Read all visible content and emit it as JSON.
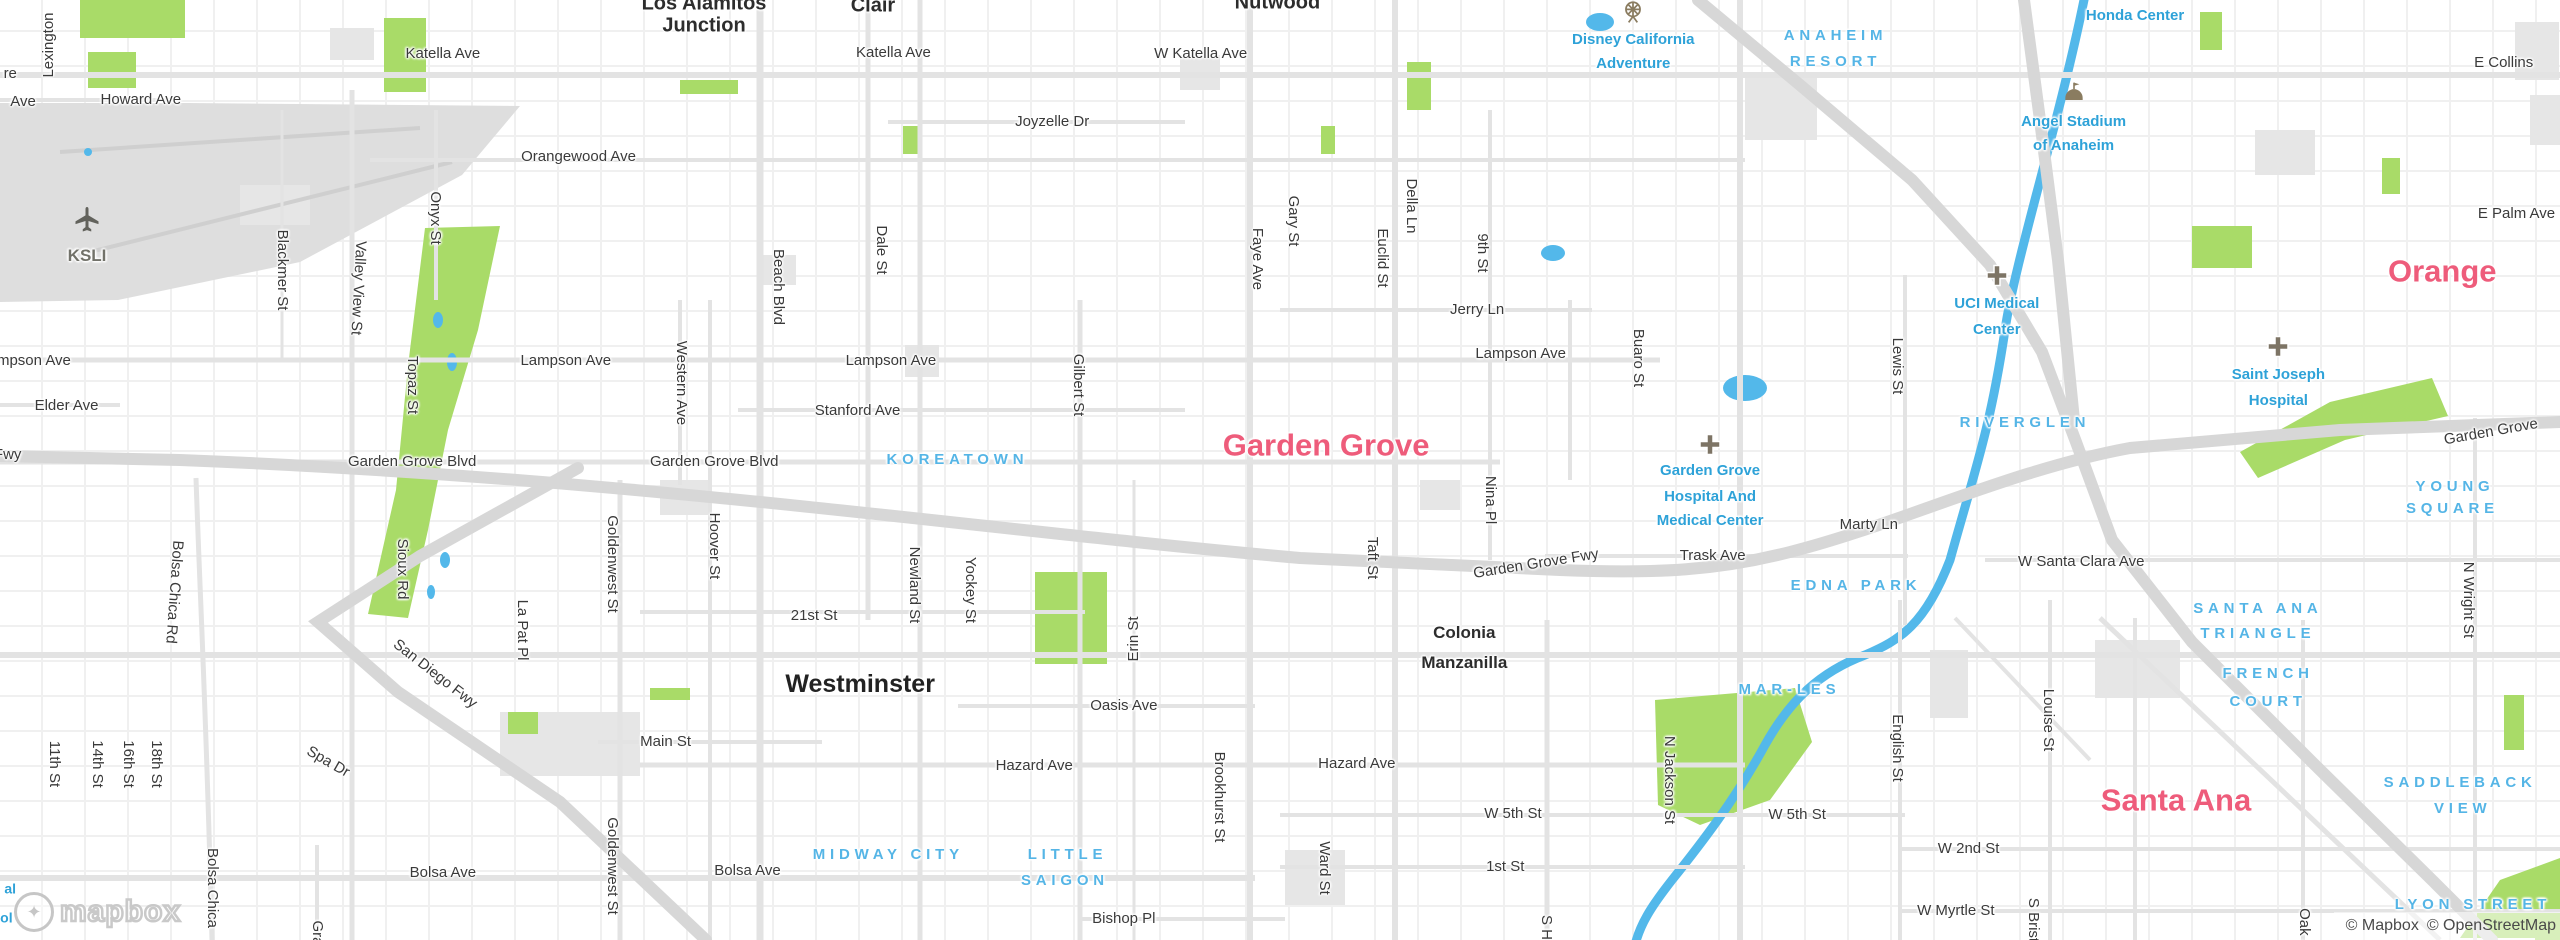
{
  "map": {
    "logo_text": "mapbox",
    "attribution": {
      "mapbox": "© Mapbox",
      "osm": "© OpenStreetMap"
    },
    "colors": {
      "city_label": "#ee5c7b",
      "poi_label": "#2ea2d8",
      "neighborhood_label": "#55b5e6",
      "street_label": "#3a3a3a",
      "park_green": "#a9db68",
      "water_blue": "#53b8ea",
      "freeway_gray": "#d7d7d7",
      "road_gray": "#e3e3e3",
      "urban_gray": "#e6e6e6"
    },
    "labels": [
      {
        "t": "re",
        "x": 0.4,
        "y": 7.9,
        "k": "st"
      },
      {
        "t": "Ave",
        "x": 0.9,
        "y": 10.9,
        "k": "st"
      },
      {
        "t": "Howard Ave",
        "x": 5.5,
        "y": 10.6,
        "k": "st"
      },
      {
        "t": "Katella Ave",
        "x": 17.3,
        "y": 5.7,
        "k": "st"
      },
      {
        "t": "Katella Ave",
        "x": 34.9,
        "y": 5.6,
        "k": "st"
      },
      {
        "t": "W Katella Ave",
        "x": 46.9,
        "y": 5.7,
        "k": "st"
      },
      {
        "t": "Joyzelle Dr",
        "x": 41.1,
        "y": 13.0,
        "k": "st"
      },
      {
        "t": "Orangewood Ave",
        "x": 22.6,
        "y": 16.7,
        "k": "st"
      },
      {
        "t": "E Collins",
        "x": 97.8,
        "y": 6.7,
        "k": "st"
      },
      {
        "t": "E Palm Ave",
        "x": 98.3,
        "y": 22.8,
        "k": "st"
      },
      {
        "t": "Jerry Ln",
        "x": 57.7,
        "y": 33.0,
        "k": "st"
      },
      {
        "t": "Lampson Ave",
        "x": 1.0,
        "y": 38.4,
        "k": "st"
      },
      {
        "t": "Elder Ave",
        "x": 2.6,
        "y": 43.2,
        "k": "st"
      },
      {
        "t": "Lampson Ave",
        "x": 22.1,
        "y": 38.4,
        "k": "st"
      },
      {
        "t": "Lampson Ave",
        "x": 34.8,
        "y": 38.4,
        "k": "st"
      },
      {
        "t": "Lampson Ave",
        "x": 59.4,
        "y": 37.7,
        "k": "st"
      },
      {
        "t": "Stanford Ave",
        "x": 33.5,
        "y": 43.7,
        "k": "st"
      },
      {
        "t": "Garden Grove Blvd",
        "x": 16.1,
        "y": 49.1,
        "k": "st"
      },
      {
        "t": "Garden Grove Blvd",
        "x": 27.9,
        "y": 49.1,
        "k": "st"
      },
      {
        "t": "Fwy",
        "x": 0.3,
        "y": 48.4,
        "k": "st"
      },
      {
        "t": "Garden Grove Fwy",
        "x": 60.0,
        "y": 60.0,
        "k": "st",
        "r": -9
      },
      {
        "t": "Trask Ave",
        "x": 66.9,
        "y": 59.1,
        "k": "st"
      },
      {
        "t": "Marty Ln",
        "x": 73.0,
        "y": 55.9,
        "k": "st"
      },
      {
        "t": "W Santa Clara Ave",
        "x": 81.3,
        "y": 59.8,
        "k": "st"
      },
      {
        "t": "Garden Grove",
        "x": 97.3,
        "y": 46.0,
        "k": "st",
        "r": -10
      },
      {
        "t": "21st St",
        "x": 31.8,
        "y": 65.5,
        "k": "st"
      },
      {
        "t": "Main St",
        "x": 26.0,
        "y": 78.9,
        "k": "st"
      },
      {
        "t": "Oasis Ave",
        "x": 43.9,
        "y": 75.1,
        "k": "st"
      },
      {
        "t": "Hazard Ave",
        "x": 40.4,
        "y": 81.5,
        "k": "st"
      },
      {
        "t": "Hazard Ave",
        "x": 53.0,
        "y": 81.3,
        "k": "st"
      },
      {
        "t": "W 5th St",
        "x": 59.1,
        "y": 86.6,
        "k": "st"
      },
      {
        "t": "W 5th St",
        "x": 70.2,
        "y": 86.7,
        "k": "st"
      },
      {
        "t": "1st St",
        "x": 58.8,
        "y": 92.2,
        "k": "st"
      },
      {
        "t": "Bolsa Ave",
        "x": 17.3,
        "y": 92.9,
        "k": "st"
      },
      {
        "t": "Bolsa Ave",
        "x": 29.2,
        "y": 92.7,
        "k": "st"
      },
      {
        "t": "Bishop Pl",
        "x": 43.9,
        "y": 97.8,
        "k": "st"
      },
      {
        "t": "W 2nd St",
        "x": 76.9,
        "y": 90.3,
        "k": "st"
      },
      {
        "t": "W Myrtle St",
        "x": 76.4,
        "y": 96.9,
        "k": "st"
      },
      {
        "t": "San Diego Fwy",
        "x": 17.0,
        "y": 71.7,
        "k": "st",
        "r": 38
      },
      {
        "t": "Spa Dr",
        "x": 12.8,
        "y": 81.1,
        "k": "st",
        "r": 30
      },
      {
        "t": "Lexington",
        "x": 1.9,
        "y": 4.8,
        "k": "st",
        "r": -90
      },
      {
        "t": "Blackmer St",
        "x": 11.0,
        "y": 28.7,
        "k": "st",
        "r": 90
      },
      {
        "t": "Valley View St",
        "x": 14.0,
        "y": 30.6,
        "k": "st",
        "r": 93
      },
      {
        "t": "Onyx St",
        "x": 17.0,
        "y": 23.2,
        "k": "st",
        "r": 90
      },
      {
        "t": "Topaz St",
        "x": 16.1,
        "y": 41.0,
        "k": "st",
        "r": 90
      },
      {
        "t": "Beach Blvd",
        "x": 30.4,
        "y": 30.5,
        "k": "st",
        "r": 90
      },
      {
        "t": "Dale St",
        "x": 34.4,
        "y": 26.6,
        "k": "st",
        "r": 90
      },
      {
        "t": "Faye Ave",
        "x": 49.1,
        "y": 27.6,
        "k": "st",
        "r": 90
      },
      {
        "t": "Gary St",
        "x": 50.5,
        "y": 23.5,
        "k": "st",
        "r": 90
      },
      {
        "t": "Della Ln",
        "x": 55.1,
        "y": 21.9,
        "k": "st",
        "r": 90
      },
      {
        "t": "Euclid St",
        "x": 54.0,
        "y": 27.4,
        "k": "st",
        "r": 90
      },
      {
        "t": "9th St",
        "x": 57.9,
        "y": 26.9,
        "k": "st",
        "r": 90
      },
      {
        "t": "Buaro St",
        "x": 64.0,
        "y": 38.1,
        "k": "st",
        "r": 90
      },
      {
        "t": "Nina Pl",
        "x": 58.2,
        "y": 53.2,
        "k": "st",
        "r": 90
      },
      {
        "t": "Taft St",
        "x": 53.6,
        "y": 59.4,
        "k": "st",
        "r": 90
      },
      {
        "t": "Lewis St",
        "x": 74.1,
        "y": 38.9,
        "k": "st",
        "r": 90
      },
      {
        "t": "Western Ave",
        "x": 26.6,
        "y": 40.7,
        "k": "st",
        "r": 90
      },
      {
        "t": "Hoover St",
        "x": 27.9,
        "y": 58.1,
        "k": "st",
        "r": 90
      },
      {
        "t": "Newland St",
        "x": 35.7,
        "y": 62.2,
        "k": "st",
        "r": 90
      },
      {
        "t": "Yockey St",
        "x": 37.9,
        "y": 62.8,
        "k": "st",
        "r": 90
      },
      {
        "t": "Gilbert St",
        "x": 42.1,
        "y": 41.0,
        "k": "st",
        "r": 90
      },
      {
        "t": "Goldenwest St",
        "x": 23.9,
        "y": 60.0,
        "k": "st",
        "r": 90
      },
      {
        "t": "Goldenwest St",
        "x": 23.9,
        "y": 92.1,
        "k": "st",
        "r": 90
      },
      {
        "t": "Sioux Rd",
        "x": 15.7,
        "y": 60.5,
        "k": "st",
        "r": 90
      },
      {
        "t": "La Pat Pl",
        "x": 20.4,
        "y": 67.0,
        "k": "st",
        "r": 90
      },
      {
        "t": "Bolsa Chica Rd",
        "x": 6.8,
        "y": 63.0,
        "k": "st",
        "r": 94
      },
      {
        "t": "Bolsa Chica",
        "x": 8.3,
        "y": 94.5,
        "k": "st",
        "r": 90
      },
      {
        "t": "11th St",
        "x": 2.1,
        "y": 81.3,
        "k": "st",
        "r": 90
      },
      {
        "t": "14th St",
        "x": 3.8,
        "y": 81.3,
        "k": "st",
        "r": 90
      },
      {
        "t": "16th St",
        "x": 5.0,
        "y": 81.3,
        "k": "st",
        "r": 90
      },
      {
        "t": "18th St",
        "x": 6.1,
        "y": 81.3,
        "k": "st",
        "r": 90
      },
      {
        "t": "Ward St",
        "x": 51.7,
        "y": 92.3,
        "k": "st",
        "r": 90
      },
      {
        "t": "N Jackson St",
        "x": 65.2,
        "y": 83.0,
        "k": "st",
        "r": 90
      },
      {
        "t": "Brookhurst St",
        "x": 47.6,
        "y": 84.8,
        "k": "st",
        "r": 90
      },
      {
        "t": "English St",
        "x": 74.1,
        "y": 79.6,
        "k": "st",
        "r": 90
      },
      {
        "t": "Louise St",
        "x": 80.0,
        "y": 76.6,
        "k": "st",
        "r": 90
      },
      {
        "t": "S Bristol St",
        "x": 79.4,
        "y": 99.5,
        "k": "st",
        "r": 90
      },
      {
        "t": "N Wright St",
        "x": 96.4,
        "y": 63.8,
        "k": "st",
        "r": 90
      },
      {
        "t": "Oak St",
        "x": 90.0,
        "y": 99.0,
        "k": "st",
        "r": 90
      },
      {
        "t": "S Harbor",
        "x": 60.4,
        "y": 100.5,
        "k": "st",
        "r": 90
      },
      {
        "t": "Gra",
        "x": 12.4,
        "y": 99.3,
        "k": "st",
        "r": 90
      },
      {
        "t": "Erin St",
        "x": 44.3,
        "y": 68.0,
        "k": "st",
        "r": -90
      },
      {
        "t": "Orange",
        "x": 95.4,
        "y": 28.9,
        "k": "city"
      },
      {
        "t": "Garden Grove",
        "x": 51.8,
        "y": 47.4,
        "k": "city"
      },
      {
        "t": "Santa Ana",
        "x": 85.0,
        "y": 85.2,
        "k": "city"
      },
      {
        "t": "Westminster",
        "x": 33.6,
        "y": 72.8,
        "k": "townlg"
      },
      {
        "t": "Los Alamitos",
        "x": 27.5,
        "y": 0.4,
        "k": "town"
      },
      {
        "t": "Junction",
        "x": 27.5,
        "y": 2.8,
        "k": "town"
      },
      {
        "t": "Nutwood",
        "x": 49.9,
        "y": 0.3,
        "k": "town"
      },
      {
        "t": "Clair",
        "x": 34.1,
        "y": 0.6,
        "k": "town"
      },
      {
        "t": "Colonia",
        "x": 57.2,
        "y": 67.3,
        "k": "townsm"
      },
      {
        "t": "Manzanilla",
        "x": 57.2,
        "y": 70.5,
        "k": "townsm"
      },
      {
        "t": "KOREATOWN",
        "x": 37.4,
        "y": 48.9,
        "k": "nbhd"
      },
      {
        "t": "ANAHEIM",
        "x": 71.7,
        "y": 3.8,
        "k": "nbhd"
      },
      {
        "t": "RESORT",
        "x": 71.7,
        "y": 6.6,
        "k": "nbhd"
      },
      {
        "t": "RIVERGLEN",
        "x": 79.1,
        "y": 45.0,
        "k": "nbhd"
      },
      {
        "t": "EDNA PARK",
        "x": 72.5,
        "y": 62.3,
        "k": "nbhd"
      },
      {
        "t": "MAR-LES",
        "x": 69.9,
        "y": 73.4,
        "k": "nbhd"
      },
      {
        "t": "YOUNG",
        "x": 95.9,
        "y": 51.8,
        "k": "nbhd"
      },
      {
        "t": "SQUARE",
        "x": 95.8,
        "y": 54.2,
        "k": "nbhd"
      },
      {
        "t": "SANTA ANA",
        "x": 88.2,
        "y": 64.8,
        "k": "nbhd"
      },
      {
        "t": "TRIANGLE",
        "x": 88.2,
        "y": 67.4,
        "k": "nbhd"
      },
      {
        "t": "FRENCH",
        "x": 88.6,
        "y": 71.7,
        "k": "nbhd"
      },
      {
        "t": "COURT",
        "x": 88.6,
        "y": 74.7,
        "k": "nbhd"
      },
      {
        "t": "MIDWAY CITY",
        "x": 34.7,
        "y": 91.0,
        "k": "nbhd"
      },
      {
        "t": "LITTLE",
        "x": 41.7,
        "y": 91.0,
        "k": "nbhd"
      },
      {
        "t": "SAIGON",
        "x": 41.6,
        "y": 93.7,
        "k": "nbhd"
      },
      {
        "t": "SADDLEBACK",
        "x": 96.1,
        "y": 83.3,
        "k": "nbhd"
      },
      {
        "t": "VIEW",
        "x": 96.2,
        "y": 86.1,
        "k": "nbhd"
      },
      {
        "t": "LYON STREET",
        "x": 96.6,
        "y": 96.3,
        "k": "nbhd"
      },
      {
        "t": "Disney California",
        "x": 63.8,
        "y": 4.3,
        "k": "poi"
      },
      {
        "t": "Adventure",
        "x": 63.8,
        "y": 6.8,
        "k": "poi"
      },
      {
        "t": "Honda Center",
        "x": 83.4,
        "y": 1.7,
        "k": "poi"
      },
      {
        "t": "Angel Stadium",
        "x": 81.0,
        "y": 13.0,
        "k": "poi"
      },
      {
        "t": "of Anaheim",
        "x": 81.0,
        "y": 15.5,
        "k": "poi"
      },
      {
        "t": "UCI Medical",
        "x": 78.0,
        "y": 32.3,
        "k": "poi"
      },
      {
        "t": "Center",
        "x": 78.0,
        "y": 35.1,
        "k": "poi"
      },
      {
        "t": "Garden Grove",
        "x": 66.8,
        "y": 50.1,
        "k": "poi"
      },
      {
        "t": "Hospital And",
        "x": 66.8,
        "y": 52.9,
        "k": "poi"
      },
      {
        "t": "Medical Center",
        "x": 66.8,
        "y": 55.4,
        "k": "poi"
      },
      {
        "t": "Saint Joseph",
        "x": 89.0,
        "y": 39.9,
        "k": "poi"
      },
      {
        "t": "Hospital",
        "x": 89.0,
        "y": 42.7,
        "k": "poi"
      },
      {
        "t": "KSLI",
        "x": 3.4,
        "y": 27.2,
        "k": "air"
      },
      {
        "t": "al",
        "x": 0.4,
        "y": 94.6,
        "k": "fb"
      },
      {
        "t": "ol",
        "x": 0.25,
        "y": 97.7,
        "k": "fb"
      }
    ],
    "icons": [
      {
        "name": "airplane-icon",
        "kind": "plane",
        "x": 3.4,
        "y": 23.6
      },
      {
        "name": "ferris-wheel-icon",
        "kind": "ferris",
        "x": 63.8,
        "y": 1.5
      },
      {
        "name": "stadium-icon",
        "kind": "stadium",
        "x": 81.0,
        "y": 10.2
      },
      {
        "name": "hospital-cross-icon",
        "kind": "cross",
        "x": 78.0,
        "y": 29.6
      },
      {
        "name": "hospital-cross-icon",
        "kind": "cross",
        "x": 66.8,
        "y": 47.5
      },
      {
        "name": "hospital-cross-icon",
        "kind": "cross",
        "x": 89.0,
        "y": 37.1
      }
    ]
  }
}
